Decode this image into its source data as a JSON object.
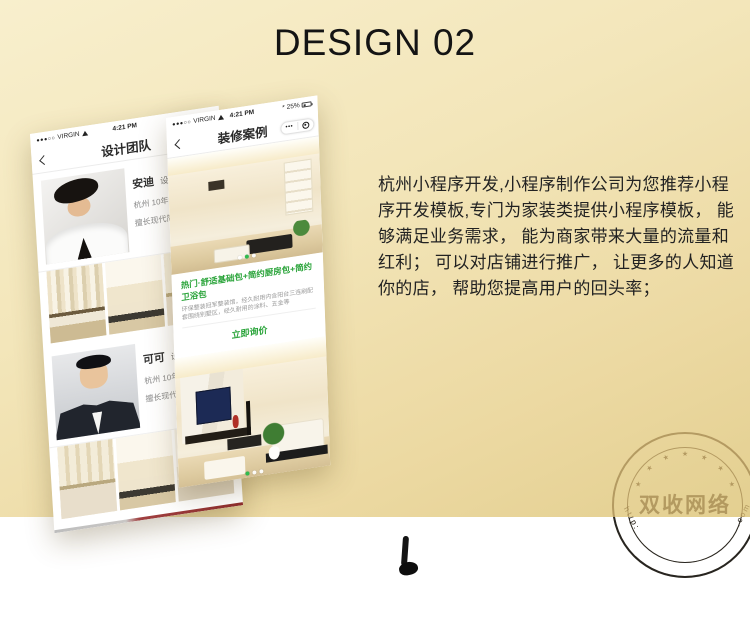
{
  "header": {
    "title": "DESIGN 02"
  },
  "intro": {
    "text": "杭州小程序开发,小程序制作公司为您推荐小程序开发模板,专门为家装类提供小程序模板， 能够满足业务需求， 能为商家带来大量的流量和红利； 可以对店铺进行推广， 让更多的人知道你的店， 帮助您提高用户的回头率；"
  },
  "team_phone": {
    "status": {
      "signal": "●●●○○",
      "carrier": "VIRGIN",
      "time": "4:21 PM"
    },
    "nav_title": "设计团队",
    "members": [
      {
        "name": "安迪",
        "role": "设计总监",
        "desc1": "杭州 10年设计经验",
        "desc2": "擅长现代简约风格"
      },
      {
        "name": "可可",
        "role": "设计总监",
        "desc1": "杭州 10年设计经验",
        "desc2": "擅长现代简约风格"
      }
    ]
  },
  "cases_phone": {
    "status": {
      "signal": "●●●○○",
      "carrier": "VIRGIN",
      "time": "4:21 PM",
      "bluetooth": "*",
      "battery": "25%"
    },
    "nav_title": "装修案例",
    "menu_dots": "•••",
    "promo": {
      "title": "热门·舒适基础包+简约厨房包+简约卫浴包",
      "desc": "环保整装冠军整装馆，经久耐用内含阳台三连刷配套围绕别墅区，经久耐用的涂料、五金等",
      "button": "立即询价"
    }
  },
  "stamp": {
    "text": "双收网络",
    "star_glyph": "★",
    "left_text": "http:",
    "right_text": ".com"
  }
}
